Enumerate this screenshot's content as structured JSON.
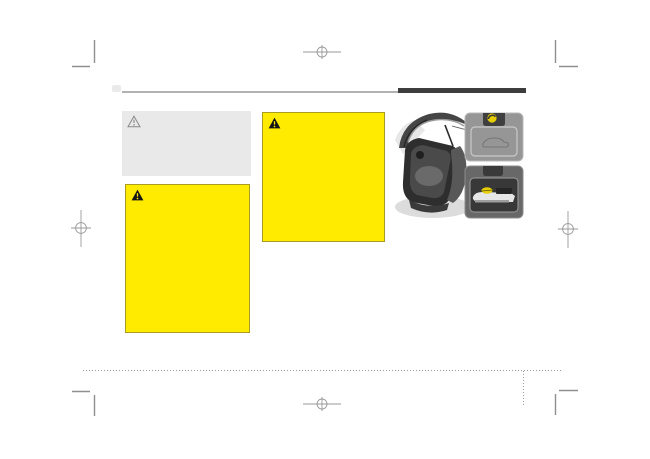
{
  "page": {
    "background": "#ffffff"
  },
  "colors": {
    "warning_yellow": "#ffeb00",
    "warning_border": "#a89d22",
    "notice_gray_bg": "#e9e9e9",
    "header_bar": "#3d3d3d",
    "header_rule": "#b2b2b2",
    "mark_gray": "#9a9a9a",
    "glow_handle_yellow": "#e6cd06"
  },
  "boxes": {
    "notice": {
      "icon": "warning-triangle-outline-icon",
      "text": ""
    },
    "warning_main": {
      "icon": "warning-triangle-icon",
      "text": ""
    },
    "warning_secondary": {
      "icon": "warning-triangle-icon",
      "text": ""
    }
  },
  "illustration": {
    "name": "tailgate-emergency-release",
    "elements": [
      "open-tailgate-car",
      "emergency-release-cover-panel",
      "glow-in-the-dark-handle"
    ]
  },
  "print_marks": {
    "corner_crop_marks": 4,
    "registration_marks": [
      "top-center",
      "bottom-center",
      "left",
      "right"
    ]
  }
}
